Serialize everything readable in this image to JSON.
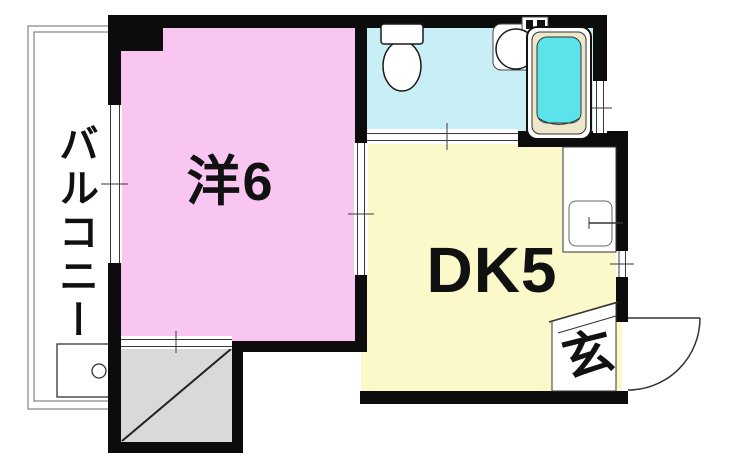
{
  "floorplan": {
    "rooms": {
      "western": {
        "label": "洋6"
      },
      "dining_kitchen": {
        "label": "DK5"
      },
      "balcony": {
        "label": "バルコニー"
      },
      "entrance": {
        "label": "玄"
      }
    },
    "fixtures": {
      "bathroom": [
        "toilet",
        "washbasin",
        "bathtub"
      ],
      "kitchen": [
        "counter-sink"
      ],
      "balcony": [
        "washing-machine-pan"
      ]
    },
    "colors": {
      "western_room": "#f8c6f0",
      "dining_kitchen": "#fbf9ca",
      "bathroom_floor": "#c8eef6",
      "bathtub_water": "#5ce2e9",
      "bathtub_rim": "#ede8cc",
      "shaft": "#d9d9d9",
      "wall": "#0c0c0c"
    }
  }
}
